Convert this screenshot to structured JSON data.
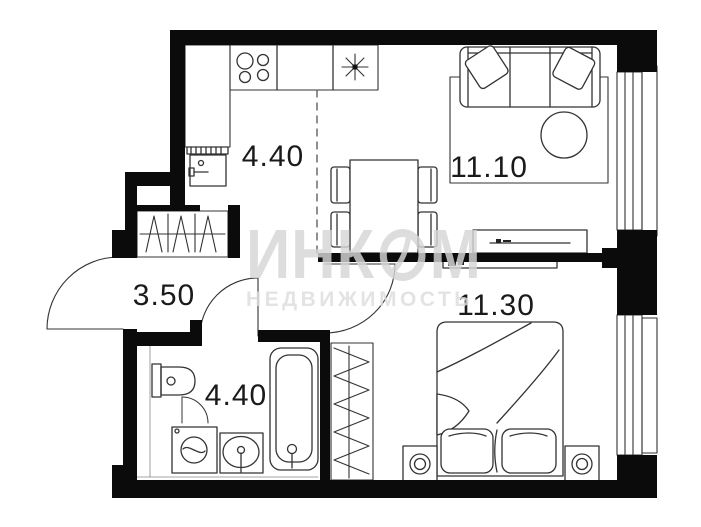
{
  "plan": {
    "type": "apartment-floor-plan",
    "rooms": {
      "kitchen": {
        "name": "kitchen-dining",
        "area": "4.40"
      },
      "living": {
        "name": "living-room",
        "area": "11.10"
      },
      "hallway": {
        "name": "hallway",
        "area": "3.50"
      },
      "bathroom": {
        "name": "bathroom",
        "area": "4.40"
      },
      "bedroom": {
        "name": "bedroom",
        "area": "11.30"
      }
    },
    "watermark": {
      "brand_part1": "ИНК",
      "brand_part2": "М",
      "subtitle": "НЕДВИЖИМОСТЬ"
    },
    "colors": {
      "wall": "#0b0b0b",
      "line": "#333333",
      "watermark": "#d6d6d6",
      "background": "#ffffff"
    }
  }
}
